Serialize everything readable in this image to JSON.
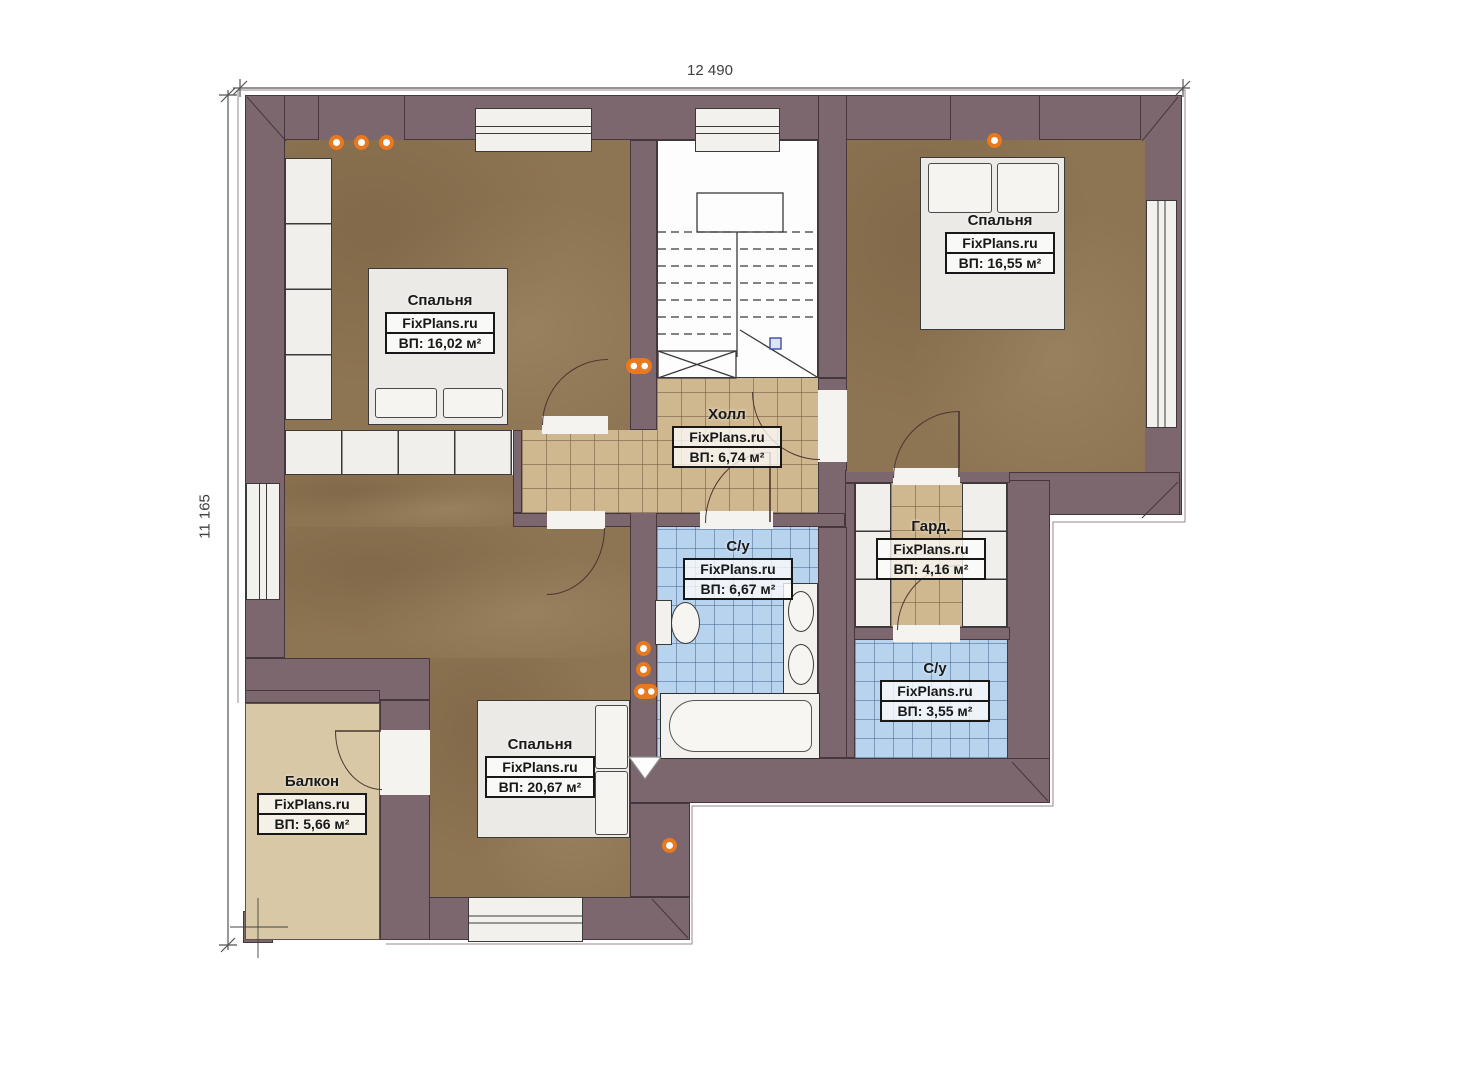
{
  "page": {
    "type": "apartment-floor-plan",
    "background": "#ffffff"
  },
  "dimensions": {
    "top": "12 490",
    "left": "11 165"
  },
  "brand": "FixPlans.ru",
  "rooms": [
    {
      "key": "bedroom-top-left",
      "name": "Спальня",
      "brand": "FixPlans.ru",
      "area": "ВП: 16,02 м²"
    },
    {
      "key": "bedroom-top-right",
      "name": "Спальня",
      "brand": "FixPlans.ru",
      "area": "ВП: 16,55 м²"
    },
    {
      "key": "hall",
      "name": "Холл",
      "brand": "FixPlans.ru",
      "area": "ВП: 6,74 м²"
    },
    {
      "key": "bathroom-center",
      "name": "С/у",
      "brand": "FixPlans.ru",
      "area": "ВП: 6,67 м²"
    },
    {
      "key": "wardrobe",
      "name": "Гард.",
      "brand": "FixPlans.ru",
      "area": "ВП: 4,16 м²"
    },
    {
      "key": "bathroom-right",
      "name": "С/у",
      "brand": "FixPlans.ru",
      "area": "ВП: 3,55 м²"
    },
    {
      "key": "bedroom-bottom",
      "name": "Спальня",
      "brand": "FixPlans.ru",
      "area": "ВП: 20,67 м²"
    },
    {
      "key": "balcony",
      "name": "Балкон",
      "brand": "FixPlans.ru",
      "area": "ВП: 5,66 м²"
    }
  ],
  "colors": {
    "wall": "#7c676e",
    "bedroom_floor": "#8d7452",
    "hall_tile": "#cfb88f",
    "bathroom_tile": "#b8d3ee",
    "balcony_floor": "#d8c8a6",
    "fixture_white": "#f2f1ed",
    "light_accent": "#e8791f",
    "stair_marker_blue": "#3b4da0"
  }
}
